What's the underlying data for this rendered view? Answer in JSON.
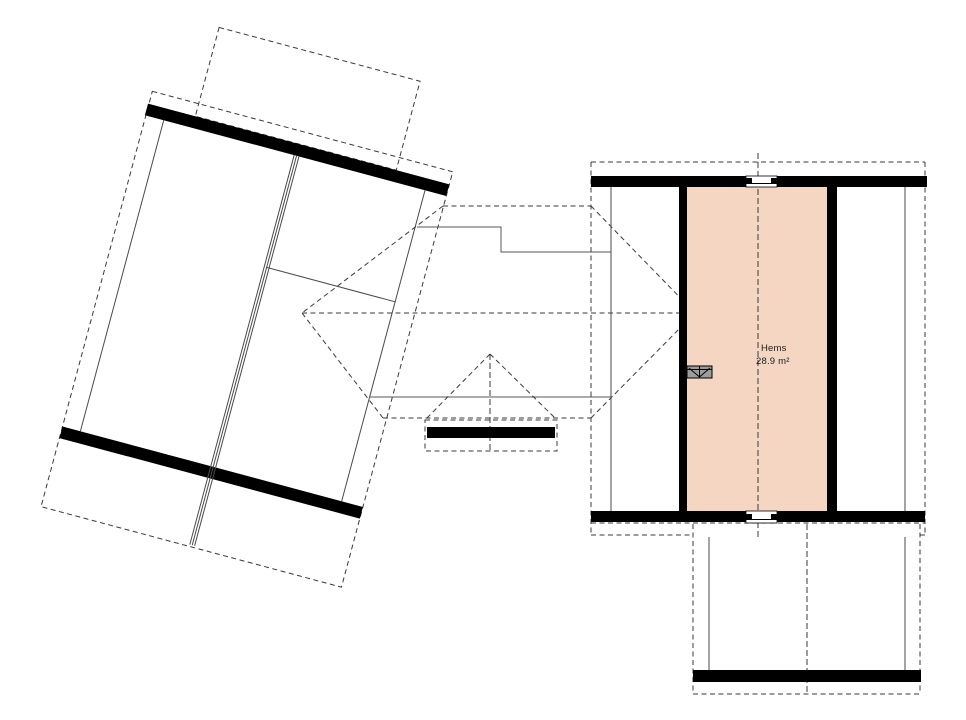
{
  "floorplan": {
    "room": {
      "name": "Hems",
      "area": "28.9 m²"
    },
    "colors": {
      "background": "#ffffff",
      "room_fill": "#f4d6c2",
      "wall": "#000000",
      "thin_line": "#4a4a4a",
      "dashed_line": "#3a3a3a",
      "hatch_fill": "#9c9c9c"
    },
    "symbols": {
      "loft_ladder": "loft-ladder-hatch-symbol",
      "window_top": "window-symbol",
      "window_bottom": "window-symbol",
      "ridge_arrow": "ridge-end-marker"
    }
  }
}
